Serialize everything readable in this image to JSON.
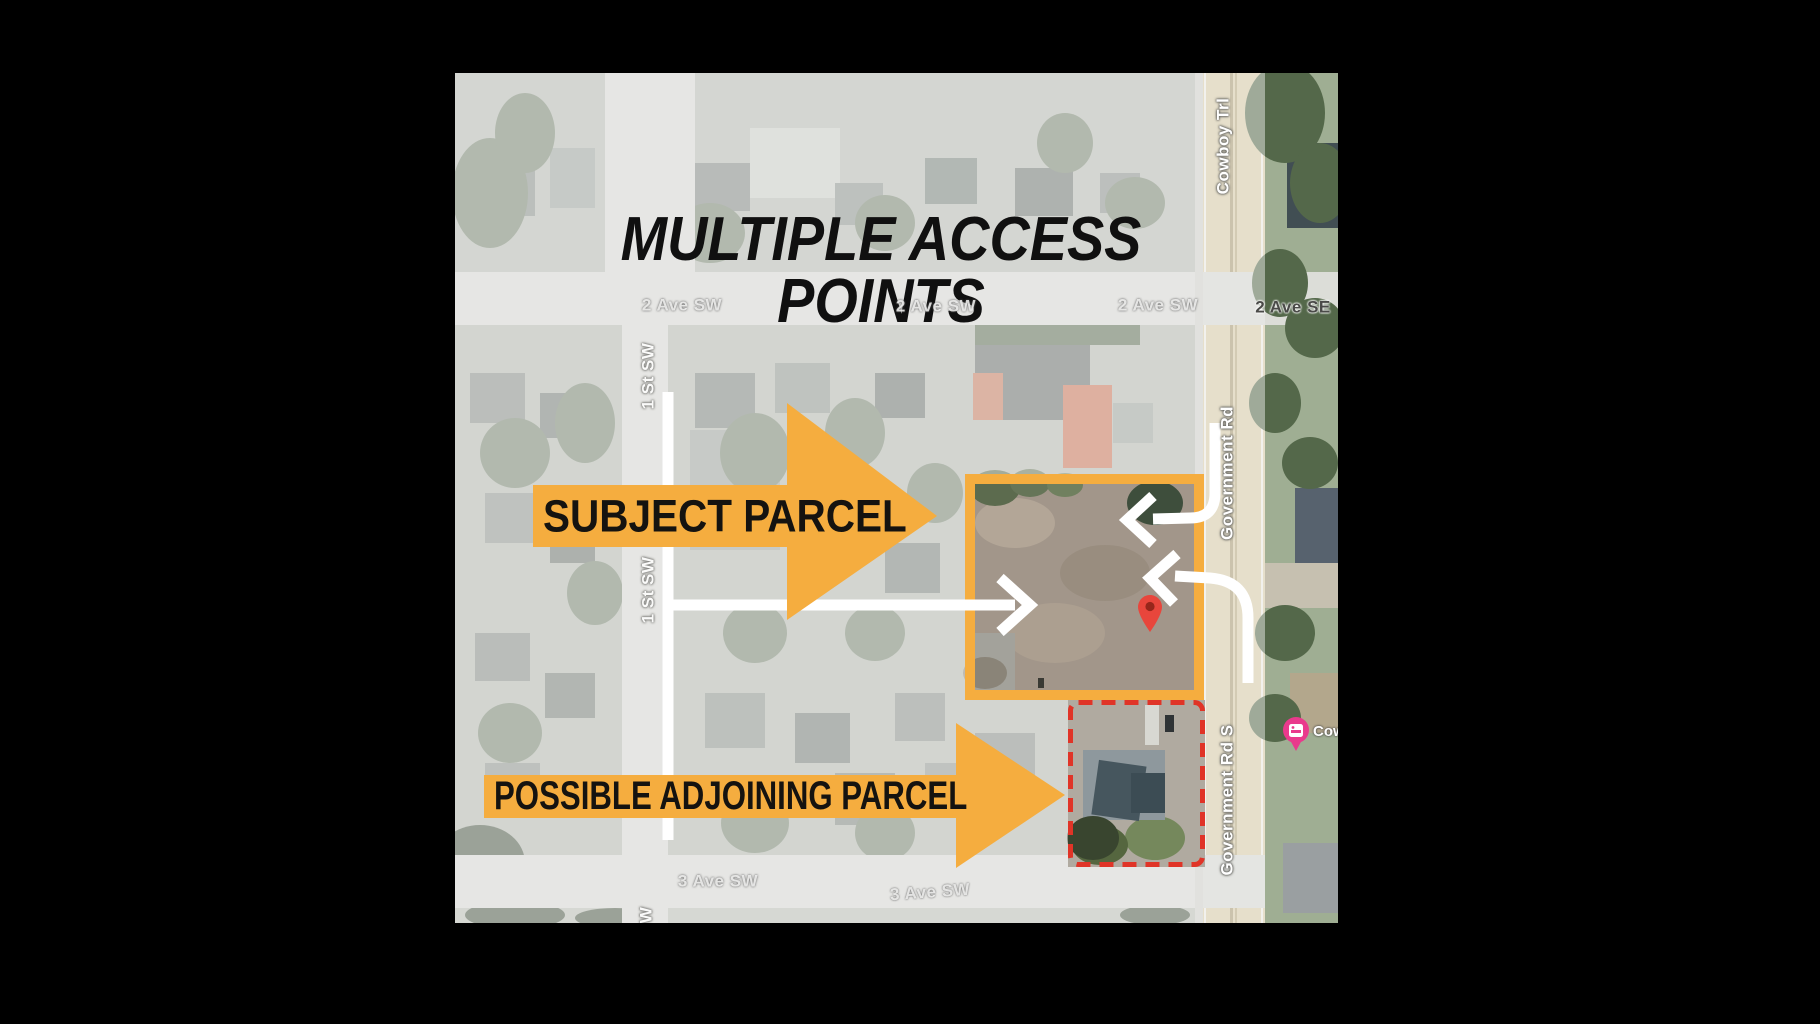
{
  "title": "MULTIPLE ACCESS POINTS",
  "annotations": {
    "subject_label": "SUBJECT PARCEL",
    "adjoining_label": "POSSIBLE ADJOINING PARCEL"
  },
  "map": {
    "street_labels": [
      {
        "text": "2 Ave SW"
      },
      {
        "text": "2 Ave SW"
      },
      {
        "text": "2 Ave SW"
      },
      {
        "text": "2 Ave SE"
      },
      {
        "text": "3 Ave SW"
      },
      {
        "text": "3 Ave SW"
      },
      {
        "text": "Cowboy Trl"
      },
      {
        "text": "Government Rd"
      },
      {
        "text": "Government Rd S"
      },
      {
        "text": "1 St SW"
      },
      {
        "text": "1 St SW"
      },
      {
        "text": "W"
      }
    ],
    "poi": {
      "label_partial": "Cow",
      "icon": "lodging-icon"
    },
    "markers": {
      "pin": "red-location-pin"
    }
  },
  "colors": {
    "accent_orange": "#F5AD3F",
    "red_dashed": "#E03427",
    "pin_red": "#E8463C",
    "pin_hole": "#96261B",
    "badge_pink": "#E93A8C",
    "white_line": "#FFFFFF",
    "title_ink": "#101010",
    "dim_overlay": "rgba(255,255,255,0.44)"
  }
}
